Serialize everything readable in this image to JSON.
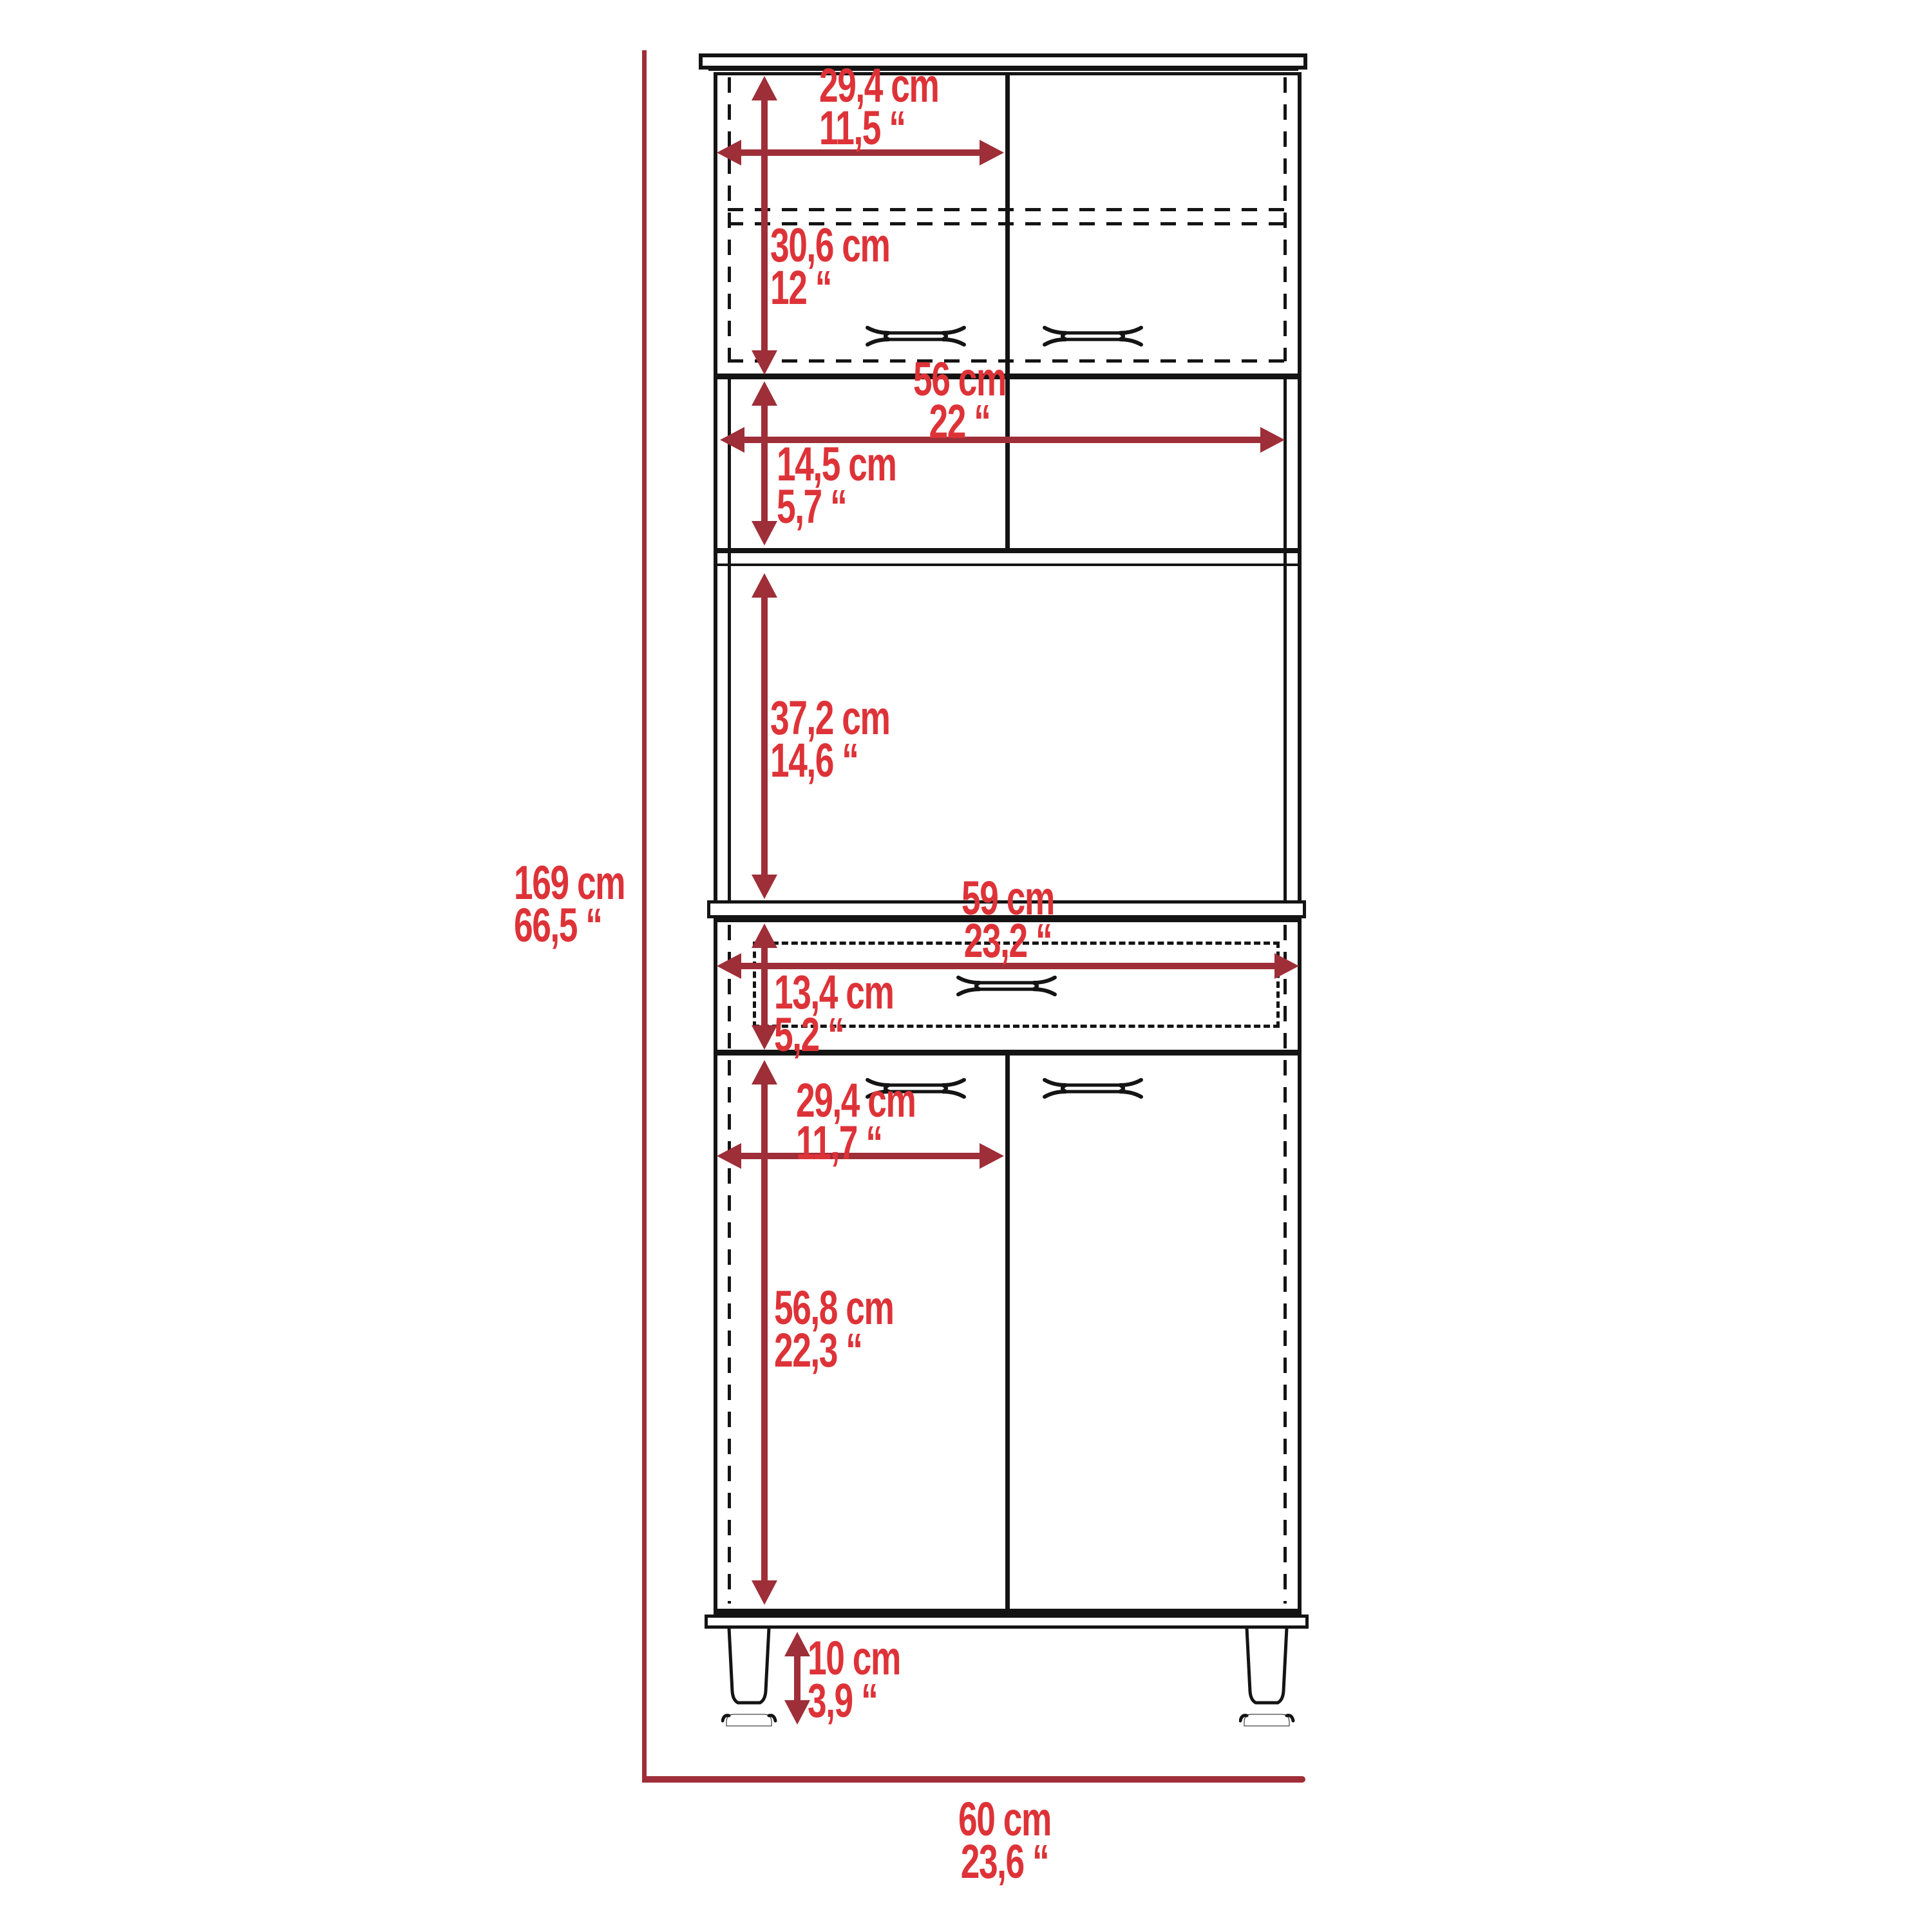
{
  "diagram_title": "cabinet-dimension-diagram",
  "colors": {
    "line": "#141414",
    "arrow": "#9e2e38",
    "text": "#dd3338"
  },
  "labels": {
    "total_height": {
      "cm": "169 cm",
      "inch": "66,5 “"
    },
    "total_width": {
      "cm": "60 cm",
      "inch": "23,6 “"
    },
    "upper_door_width": {
      "cm": "29,4 cm",
      "inch": "11,5 “"
    },
    "upper_section_height": {
      "cm": "30,6 cm",
      "inch": "12 “"
    },
    "open_shelf_width": {
      "cm": "56 cm",
      "inch": "22 “"
    },
    "open_shelf_height": {
      "cm": "14,5 cm",
      "inch": "5,7 “"
    },
    "microwave_space_height": {
      "cm": "37,2 cm",
      "inch": "14,6 “"
    },
    "drawer_width": {
      "cm": "59 cm",
      "inch": "23,2 “"
    },
    "drawer_height": {
      "cm": "13,4 cm",
      "inch": "5,2 “"
    },
    "lower_door_width": {
      "cm": "29,4 cm",
      "inch": "11,7 “"
    },
    "lower_door_height": {
      "cm": "56,8 cm",
      "inch": "22,3 “"
    },
    "leg_height": {
      "cm": "10 cm",
      "inch": "3,9 “"
    }
  }
}
